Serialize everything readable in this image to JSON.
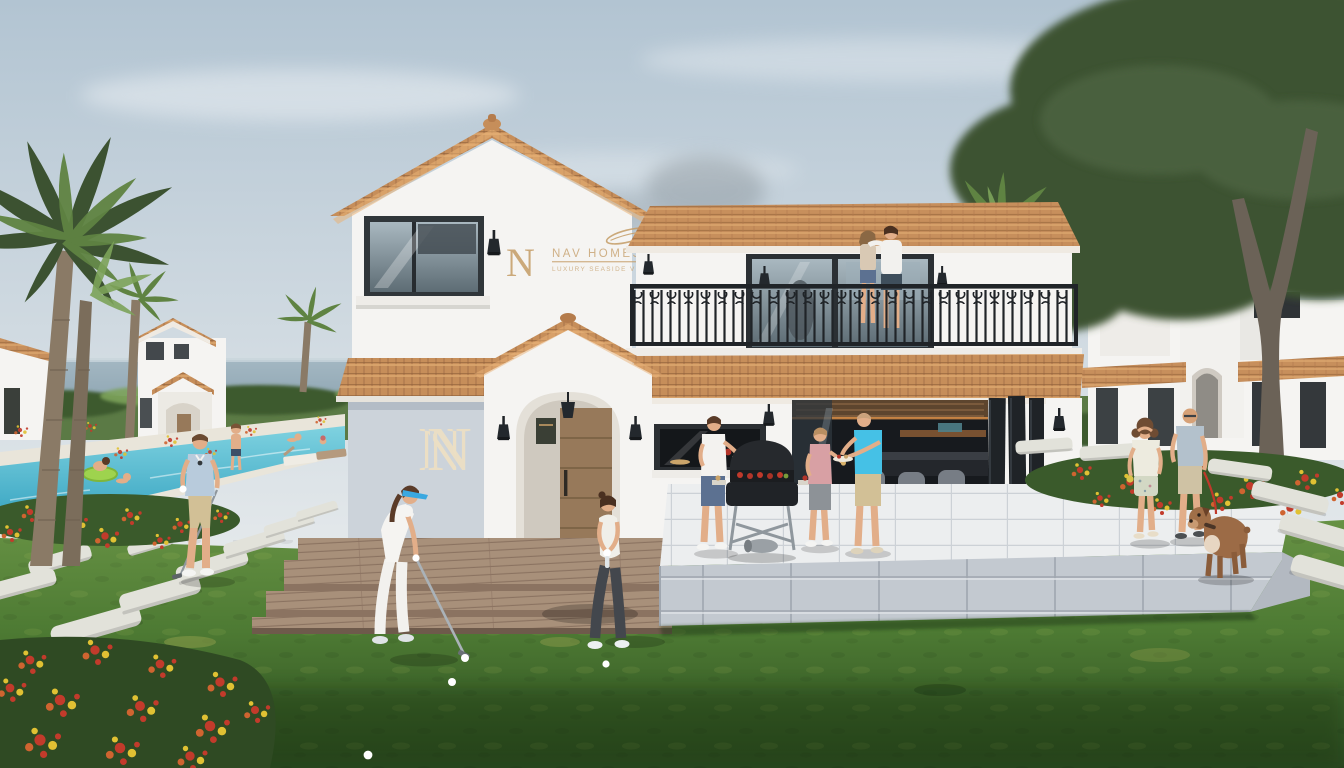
{
  "scene_title": "Seaside Mediterranean villa resort — exterior architectural rendering",
  "branding": {
    "monogram": "N",
    "line1": "NAV HOMES",
    "line2": "LUXURY SEASIDE VILLAS",
    "wall_monogram": "N"
  },
  "people": [
    {
      "id": "golfer-visor",
      "desc": "woman in white golf outfit with blue sun visor putting on the lawn"
    },
    {
      "id": "golfer-leggings",
      "desc": "woman in white tank top and dark leggings lining up a putt"
    },
    {
      "id": "pool-golfer-man",
      "desc": "man in light-blue polo and beige shorts holding a golf club on stepping stones"
    },
    {
      "id": "bbq-man-white-polo",
      "desc": "man in white polo and denim shorts holding a plate at the barbecue"
    },
    {
      "id": "bbq-man-pink-shirt",
      "desc": "man in pink shirt and grey shorts eating at the barbecue"
    },
    {
      "id": "bbq-man-cyan-shirt",
      "desc": "man in cyan t-shirt and khaki shorts holding a plate"
    },
    {
      "id": "balcony-couple",
      "desc": "couple embracing on the first-floor balcony"
    },
    {
      "id": "walking-woman",
      "desc": "woman in white top and floral shorts walking on the terrace path"
    },
    {
      "id": "walking-man",
      "desc": "bald man in steel-blue t-shirt walking a brown dog on a red leash"
    },
    {
      "id": "dog",
      "desc": "brown bulldog on red leash at the terrace corner"
    },
    {
      "id": "swimmers",
      "desc": "four swimmers in the pool, one on a green inflatable ring"
    },
    {
      "id": "pool-child",
      "desc": "child standing at the far pool edge"
    }
  ],
  "elements": {
    "buildings": [
      "main two-storey white villa with tower gable, arched entrance portico and balcony",
      "small gabled villa with porch in left background",
      "arched-portico patio house in right background",
      "partial white building at far left edge"
    ],
    "amenities": [
      "long swimming pool",
      "sun loungers",
      "outdoor summer kitchen with bar stools",
      "barbecue grill",
      "wooden deck with three steps",
      "raised white-tile terrace",
      "stepping-stone paths",
      "red and yellow flower beds",
      "palm trees",
      "large olive tree"
    ],
    "golf_balls": 4
  },
  "palette": {
    "sky1": "#b2c4d2",
    "sky2": "#e6eaec",
    "sea1": "#a3b7c2",
    "sea2": "#8ea5b2",
    "hedge": "#5b7a45",
    "hedge_dark": "#3c5a2e",
    "pool1": "#7fd2e0",
    "pool2": "#2f9fbe",
    "coping": "#e9e5da",
    "wall": "#f5f4f2",
    "wall_shade": "#ccd3da",
    "wall_warm": "#e8e4dd",
    "roof1": "#c68e5a",
    "roof2": "#dca76e",
    "roof3": "#9c6b40",
    "iron": "#202428",
    "glass1": "#a9b8c0",
    "glass2": "#5d6c74",
    "door_wood": "#97795a",
    "deck1": "#a8907a",
    "deck2": "#8b7361",
    "terrace_top": "#eceeef",
    "terrace_line": "#ccd1d6",
    "terrace_face": "#c3c9d0",
    "terrace_joint": "#9fa6af",
    "grass1": "#679244",
    "grass2": "#4d7a33",
    "grass3": "#2c4a20",
    "gold": "#c49c66",
    "cream": "#ecdfc4",
    "skin": "#e2ae89",
    "stone": "#e2e2da",
    "flower_red": "#c23b2b",
    "flower_yellow": "#e0c133",
    "flower_orange": "#cf6430",
    "leaf_palm": "#5f8342",
    "leaf_palm2": "#7da35a",
    "leaf_dark": "#3c5231",
    "trunk": "#8a7a66",
    "denim": "#5c7191",
    "polo_blue": "#b8cbdc",
    "shirt_pink": "#d8a0a4",
    "shirt_cyan": "#45c1e6",
    "shorts_khaki": "#d2c096",
    "leggings": "#43474d",
    "dog_brown": "#9c6b46",
    "float_green": "#9ed34e",
    "visor_blue": "#3aa8e0",
    "leash_red": "#c0392b"
  }
}
